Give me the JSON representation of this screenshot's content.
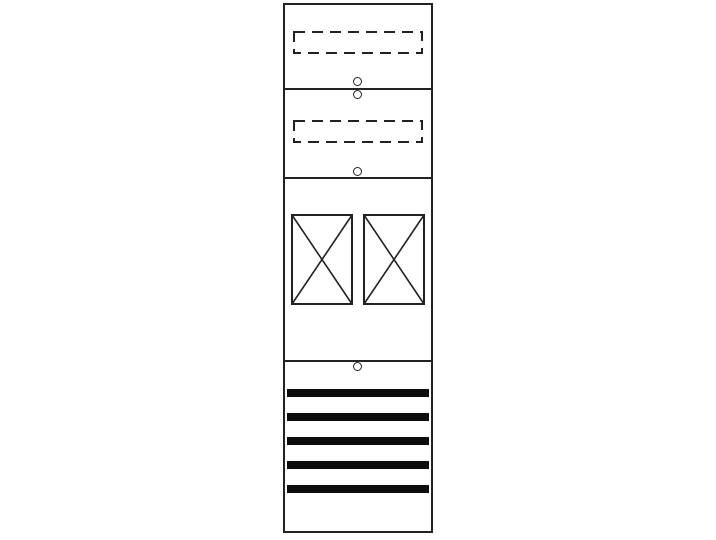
{
  "figure": {
    "name": "meter-panel-field-drawing",
    "background_color": "#ffffff",
    "line_color": "#222222",
    "bar_fill_color": "#0d0d0d"
  },
  "panel": {
    "sections": [
      {
        "name": "top-cover-section",
        "dashed_cutouts": 1,
        "fixing_holes": 1
      },
      {
        "name": "upper-cover-section",
        "dashed_cutouts": 1,
        "fixing_holes": 2
      },
      {
        "name": "meter-section",
        "meter_positions": 2,
        "fixing_holes": 0
      },
      {
        "name": "lower-distribution-section",
        "busbar_rows": 5,
        "fixing_holes": 1
      }
    ],
    "meter_positions": 2,
    "busbar_rows": 5,
    "fixing_holes_total": 4,
    "dashed_cutouts_total": 2
  }
}
